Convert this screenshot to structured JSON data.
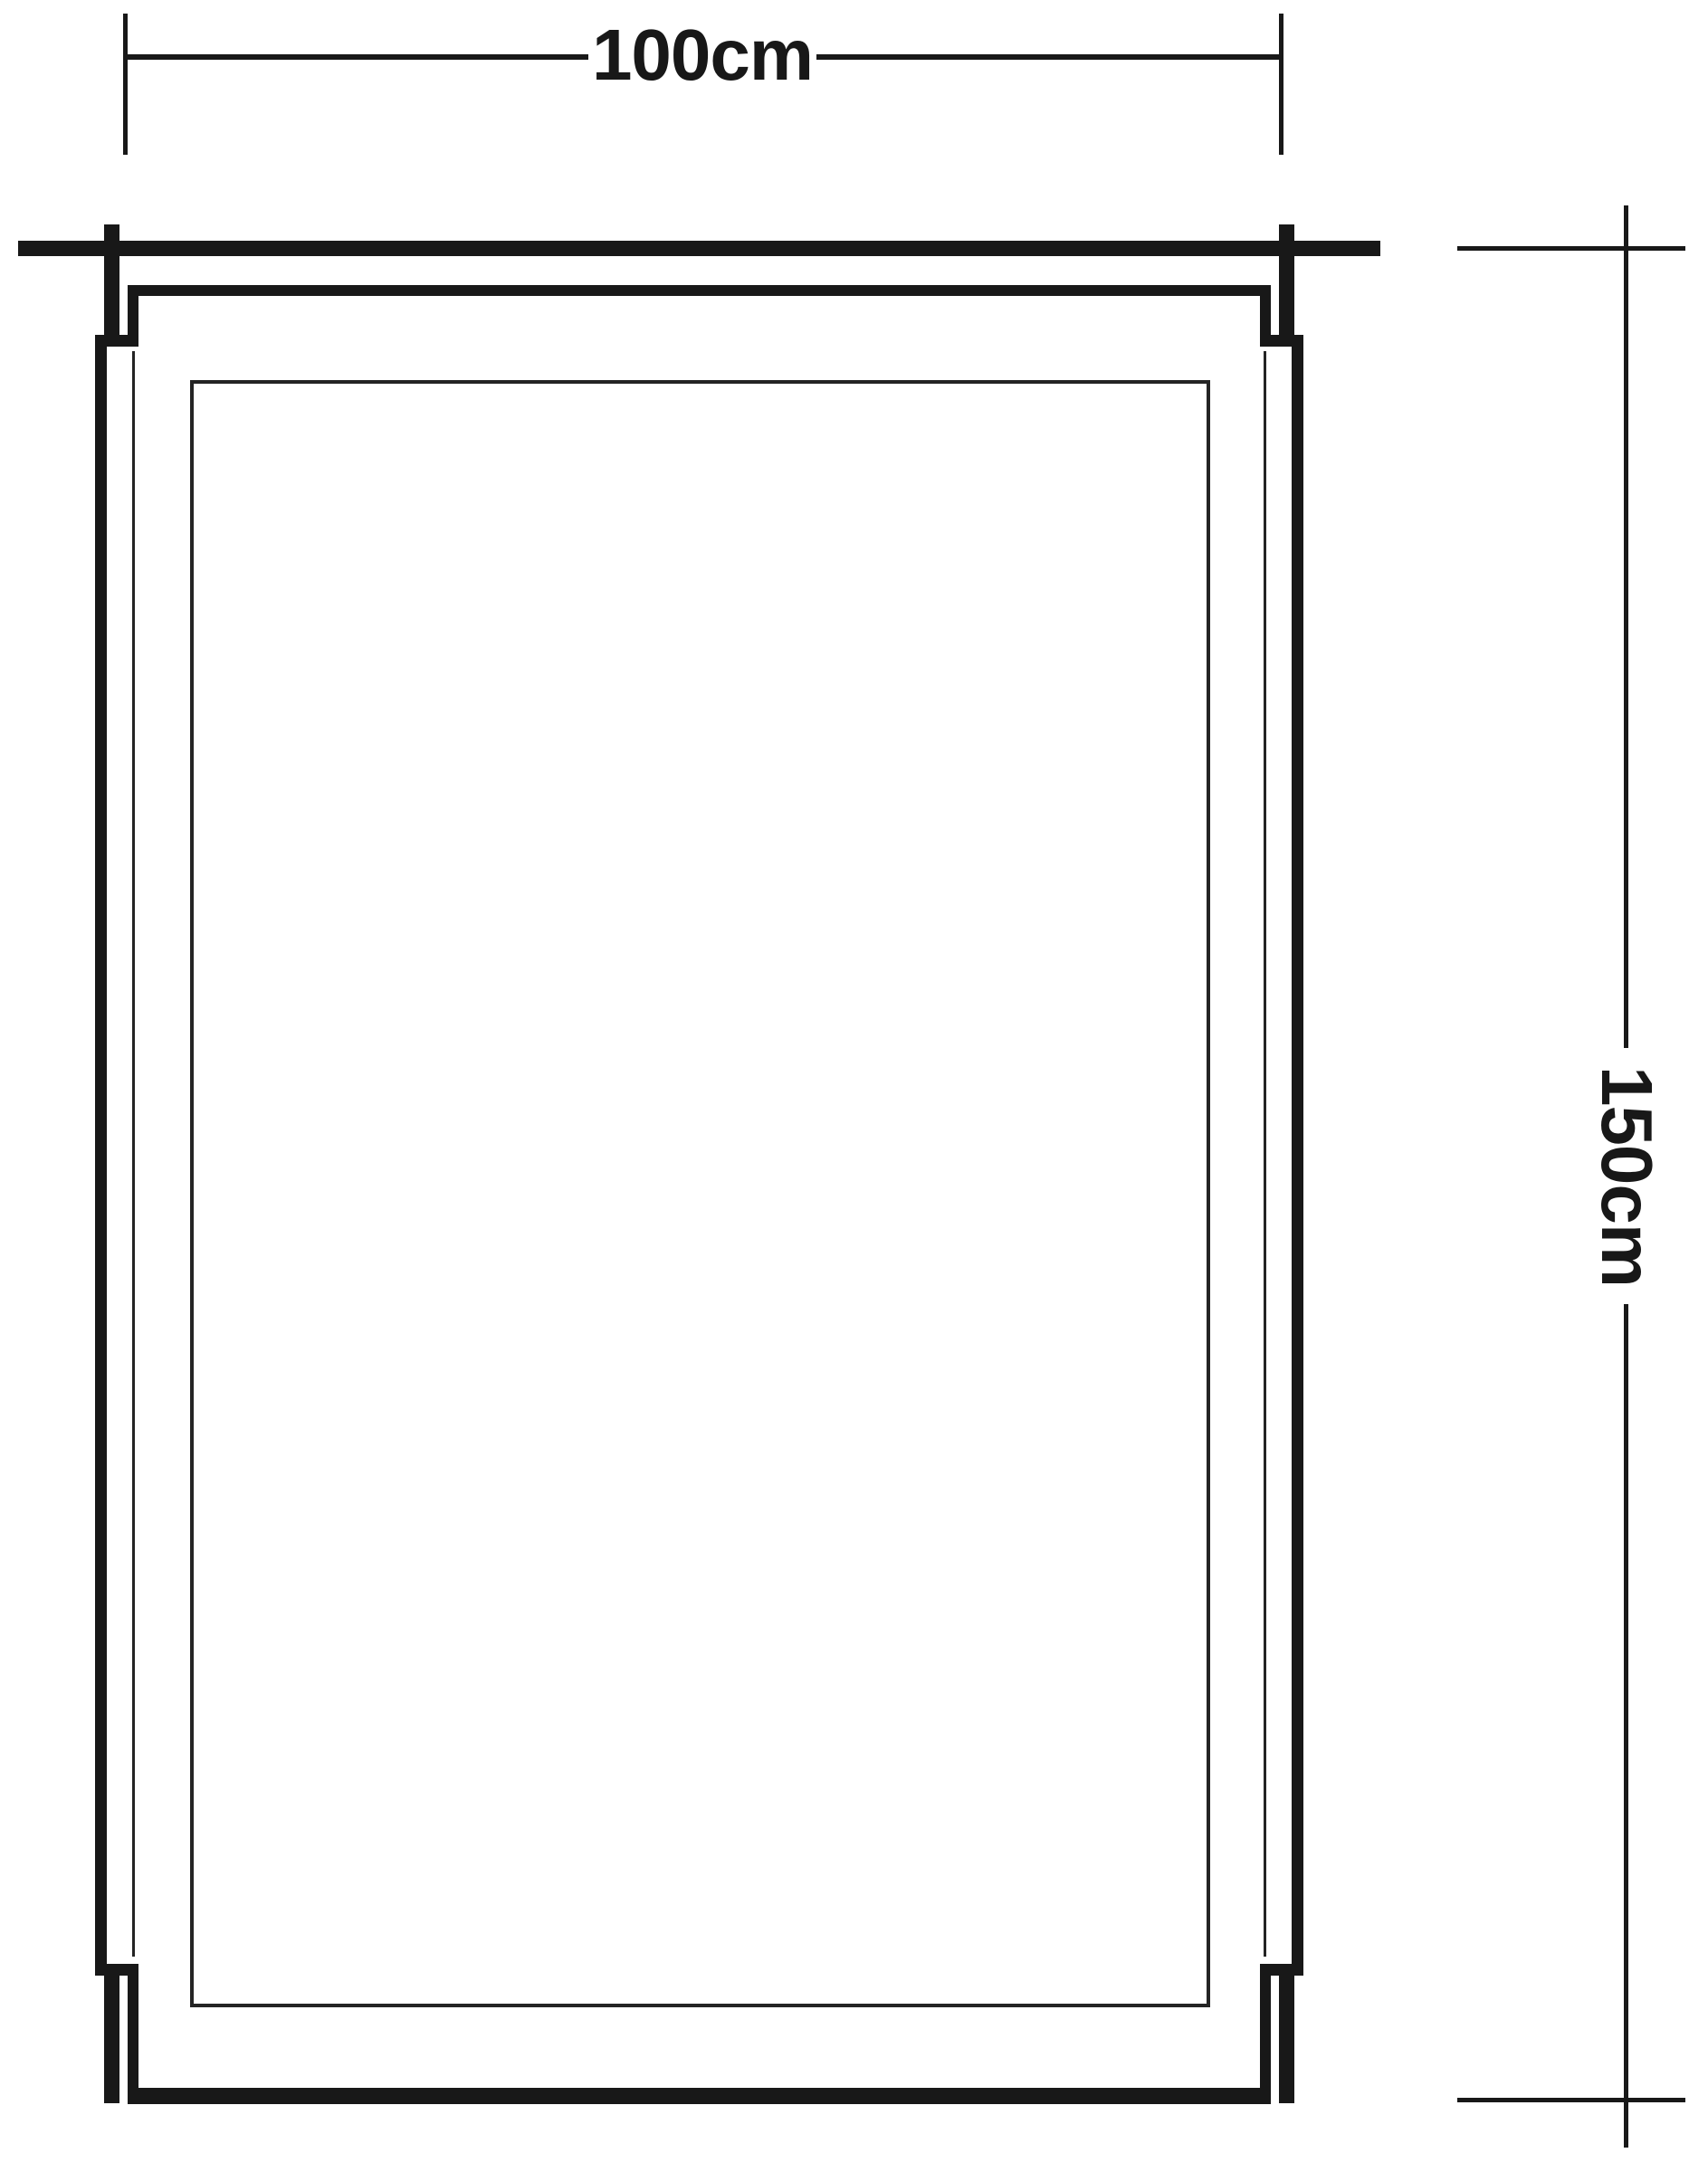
{
  "drawing": {
    "type": "window elevation technical drawing",
    "ink_color": "#181818",
    "background_color": "#ffffff"
  },
  "dimensions": {
    "width_label": "100cm",
    "height_label": "150cm"
  }
}
